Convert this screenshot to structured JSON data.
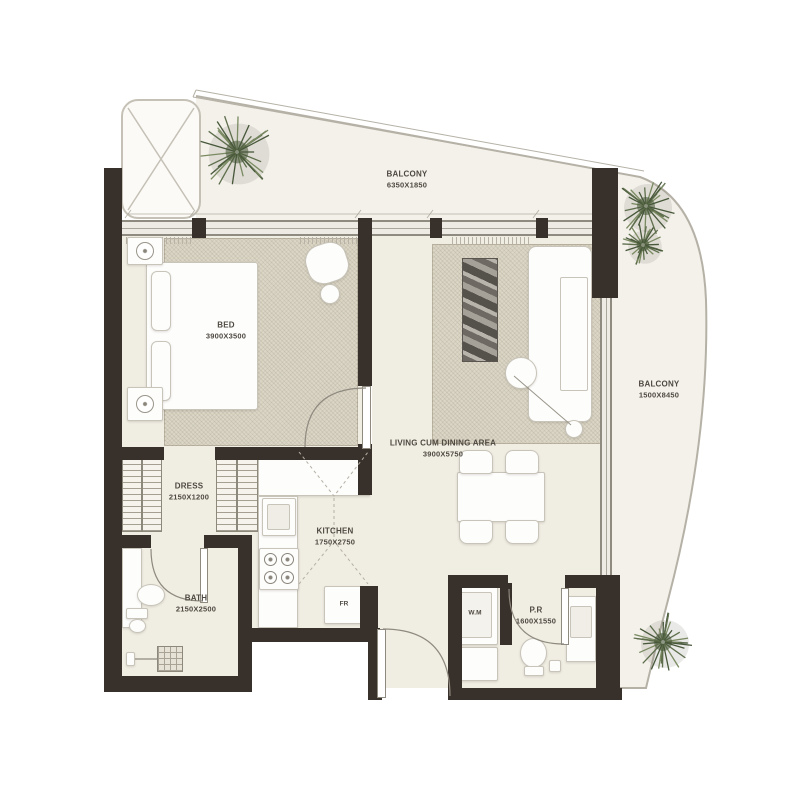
{
  "plan_title": "apartment-floor-plan",
  "colors": {
    "wall": "#38302a",
    "floor": "#f0ede3",
    "balcony_floor": "#f3f1ea",
    "rug": "#dbd6c6",
    "plant_green": "#5e6e4d",
    "line_gray": "#8f8a80",
    "label_text": "#4e4941"
  },
  "rooms": {
    "balcony_top": {
      "name": "BALCONY",
      "dims": "6350X1850"
    },
    "bedroom": {
      "name": "BED",
      "dims": "3900X3500"
    },
    "dress": {
      "name": "DRESS",
      "dims": "2150X1200"
    },
    "kitchen": {
      "name": "KITCHEN",
      "dims": "1750X2750"
    },
    "living": {
      "name": "LIVING CUM DINING AREA",
      "dims": "3900X5750"
    },
    "bath": {
      "name": "BATH",
      "dims": "2150X2500"
    },
    "pr": {
      "name": "P.R",
      "dims": "1600X1550"
    },
    "balcony_right": {
      "name": "BALCONY",
      "dims": "1500X8450"
    }
  },
  "appliances": {
    "washing_machine": "W.M",
    "fridge": "FR"
  }
}
